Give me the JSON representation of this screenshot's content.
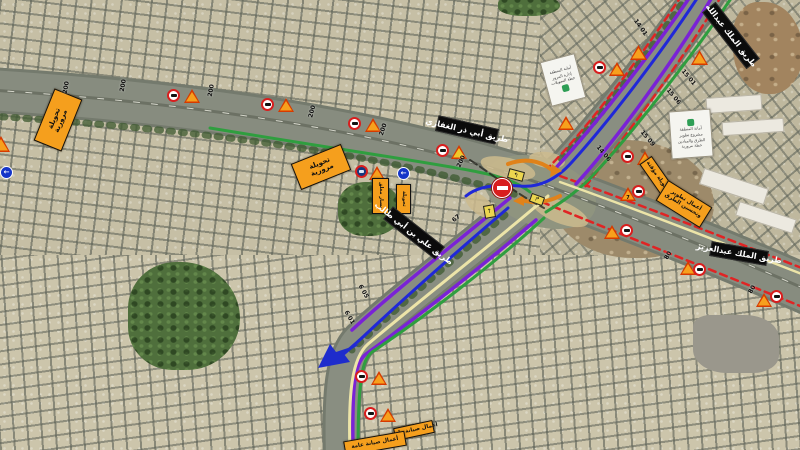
{
  "legend": {
    "route_colors": {
      "purple": "#7a22d6",
      "blue": "#2028d8",
      "green": "#2f9e3f",
      "yellow": "#ece4a8",
      "red_dash": "#e02424",
      "orange_arrow": "#e0821a"
    },
    "sign_colors": {
      "board_orange": "#f59f1d",
      "board_black": "#0b0b0b",
      "triangle_fill": "#f7a01d",
      "triangle_border": "#d63a00",
      "circle_ring": "#d81e1e",
      "arrow_blue": "#1e2ccc"
    }
  },
  "boards": {
    "detour_west": {
      "line1": "تحويلة",
      "line2": "مرورية"
    },
    "detour_center": {
      "line1": "تحويلة",
      "line2": "مرورية"
    },
    "works_se": {
      "line1": "أعمال تطوير",
      "line2": "وتحسين الطرق"
    },
    "ramp_sign": {
      "line1": "تحويلة مؤقتة"
    },
    "lane_closure_a": {
      "line1": "مسار مغلق"
    },
    "lane_closure_b": {
      "line1": "تحويلة"
    },
    "maint_a": {
      "line1": "أعمال صيانة طرق"
    },
    "maint_b": {
      "line1": "أعمال صيانة عامة"
    },
    "street_north": "طريق الملك عبدالله",
    "street_west": "طريق أبي ذر الغفاري",
    "street_south": "طريق علي بن أبي طالب",
    "street_east": "طريق الملك عبدالعزيز",
    "info_a": {
      "lines": [
        "أمانة المنطقة",
        "إدارة المرور",
        "خطة التحويلات"
      ]
    },
    "info_b": {
      "lines": [
        "أمانة المنطقة",
        "مشروع تطوير",
        "الطرق والميادين",
        "خطة مرورية"
      ]
    }
  },
  "markers": {
    "distance_labels": [
      "200",
      "200",
      "200",
      "200",
      "200",
      "200",
      "80",
      "80",
      "15 01",
      "15 06",
      "15 09",
      "14 01",
      "14 06",
      "6 01",
      "6 05",
      "67"
    ],
    "triangle_number": "7",
    "blue_circle_glyph": "←"
  }
}
